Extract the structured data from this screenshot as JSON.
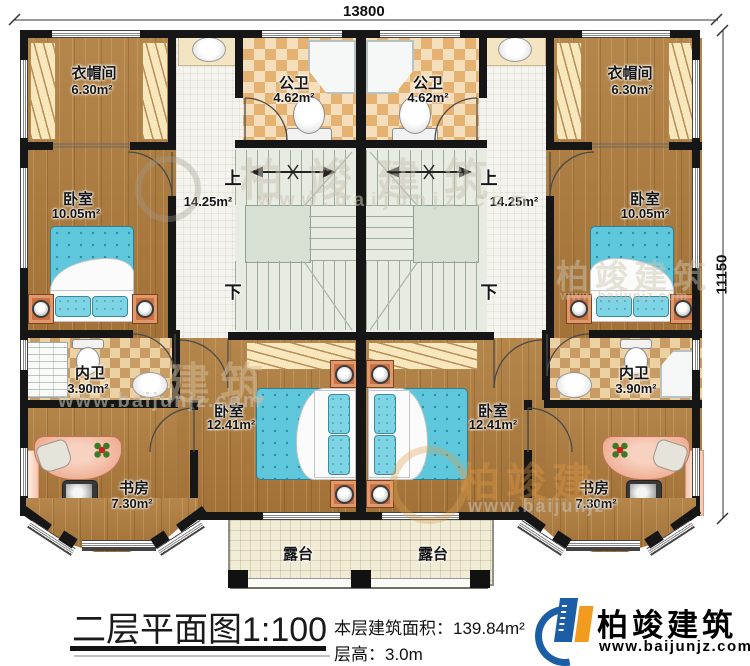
{
  "dimensions": {
    "width_mm": "13800",
    "height_mm": "11150"
  },
  "rooms": {
    "cloakroom_left": {
      "name": "衣帽间",
      "area": "6.30m²"
    },
    "cloakroom_right": {
      "name": "衣帽间",
      "area": "6.30m²"
    },
    "bedroom_small_left": {
      "name": "卧室",
      "area": "10.05m²"
    },
    "bedroom_small_right": {
      "name": "卧室",
      "area": "10.05m²"
    },
    "public_bath_left": {
      "name": "公卫",
      "area": "4.62m²"
    },
    "public_bath_right": {
      "name": "公卫",
      "area": "4.62m²"
    },
    "stairs_left": {
      "up": "上",
      "down": "下",
      "area": "14.25m²"
    },
    "stairs_right": {
      "up": "上",
      "down": "下",
      "area": "14.25m²"
    },
    "ensuite_left": {
      "name": "内卫",
      "area": "3.90m²"
    },
    "ensuite_right": {
      "name": "内卫",
      "area": "3.90m²"
    },
    "study_left": {
      "name": "书房",
      "area": "7.30m²"
    },
    "study_right": {
      "name": "书房",
      "area": "7.30m²"
    },
    "bedroom_large_left": {
      "name": "卧室",
      "area": "12.41m²"
    },
    "bedroom_large_right": {
      "name": "卧室",
      "area": "12.41m²"
    },
    "terrace_left": {
      "name": "露台"
    },
    "terrace_right": {
      "name": "露台"
    }
  },
  "title_block": {
    "plan_title": "二层平面图",
    "scale": "1:100",
    "floor_area_label": "本层建筑面积：",
    "floor_area_value": "139.84m²",
    "floor_height_label": "层高：",
    "floor_height_value": "3.0m"
  },
  "brand": {
    "name": "柏竣建筑",
    "website": "www.baijunjz.com"
  },
  "watermarks": {
    "brand": "柏竣建筑",
    "brand_short": "建筑",
    "brand_partial": "柏竣建",
    "site": "www.baijunjz.com",
    "site_short": "www.baijunjz"
  },
  "colors": {
    "wall": "#161616",
    "wood_floor": "#aa7a3e",
    "tile_light": "#f4debc",
    "tile_accent": "#e5b271",
    "stair": "#e7ebe2",
    "bed": "#5ec7dc",
    "nightstand": "#cb7144",
    "terrace": "#f1ecd6",
    "logo_blue": "#1b5ea6",
    "logo_orange": "#f29c1f"
  }
}
